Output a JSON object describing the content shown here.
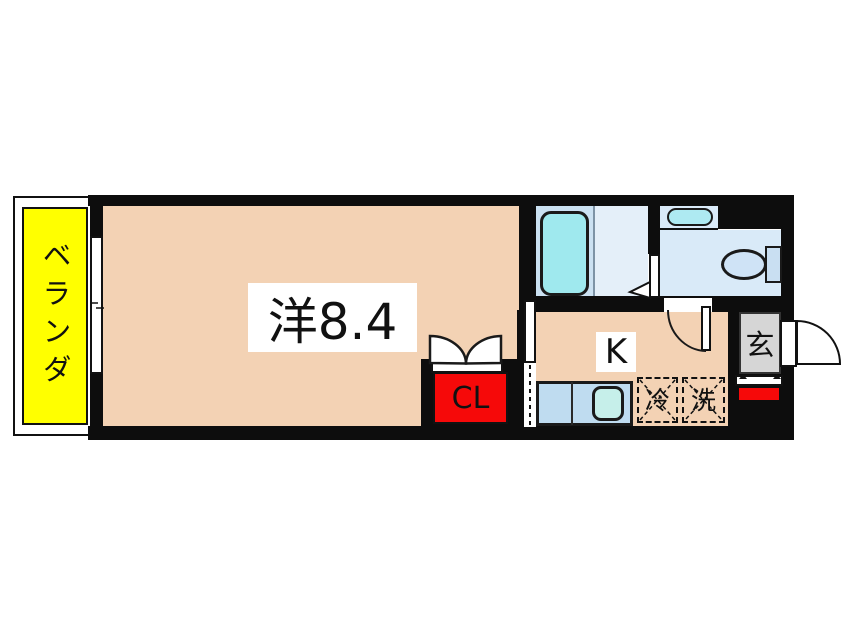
{
  "figure": "apartment-floorplan",
  "rooms": {
    "balcony": {
      "label": "ベランダ",
      "color": "#ffff00"
    },
    "western_room": {
      "label": "洋8.4",
      "color": "#f3d2b4"
    },
    "kitchen": {
      "label": "K",
      "color": "#f3d2b4"
    },
    "closet": {
      "label": "CL",
      "color": "#f60909"
    },
    "entrance": {
      "label": "玄",
      "color": "#d6d6d6"
    },
    "refrigerator_space": {
      "label": "冷"
    },
    "washing_machine_space": {
      "label": "洗"
    }
  },
  "fixtures": {
    "bathtub_color": "#9fe9ee",
    "bathroom_floor_color": "#cbe1f2",
    "toilet_floor_color": "#d9eaf8",
    "kitchen_counter_color": "#bfdcf0",
    "wall_color": "#0d0d0d",
    "accent_red": "#f60909"
  }
}
